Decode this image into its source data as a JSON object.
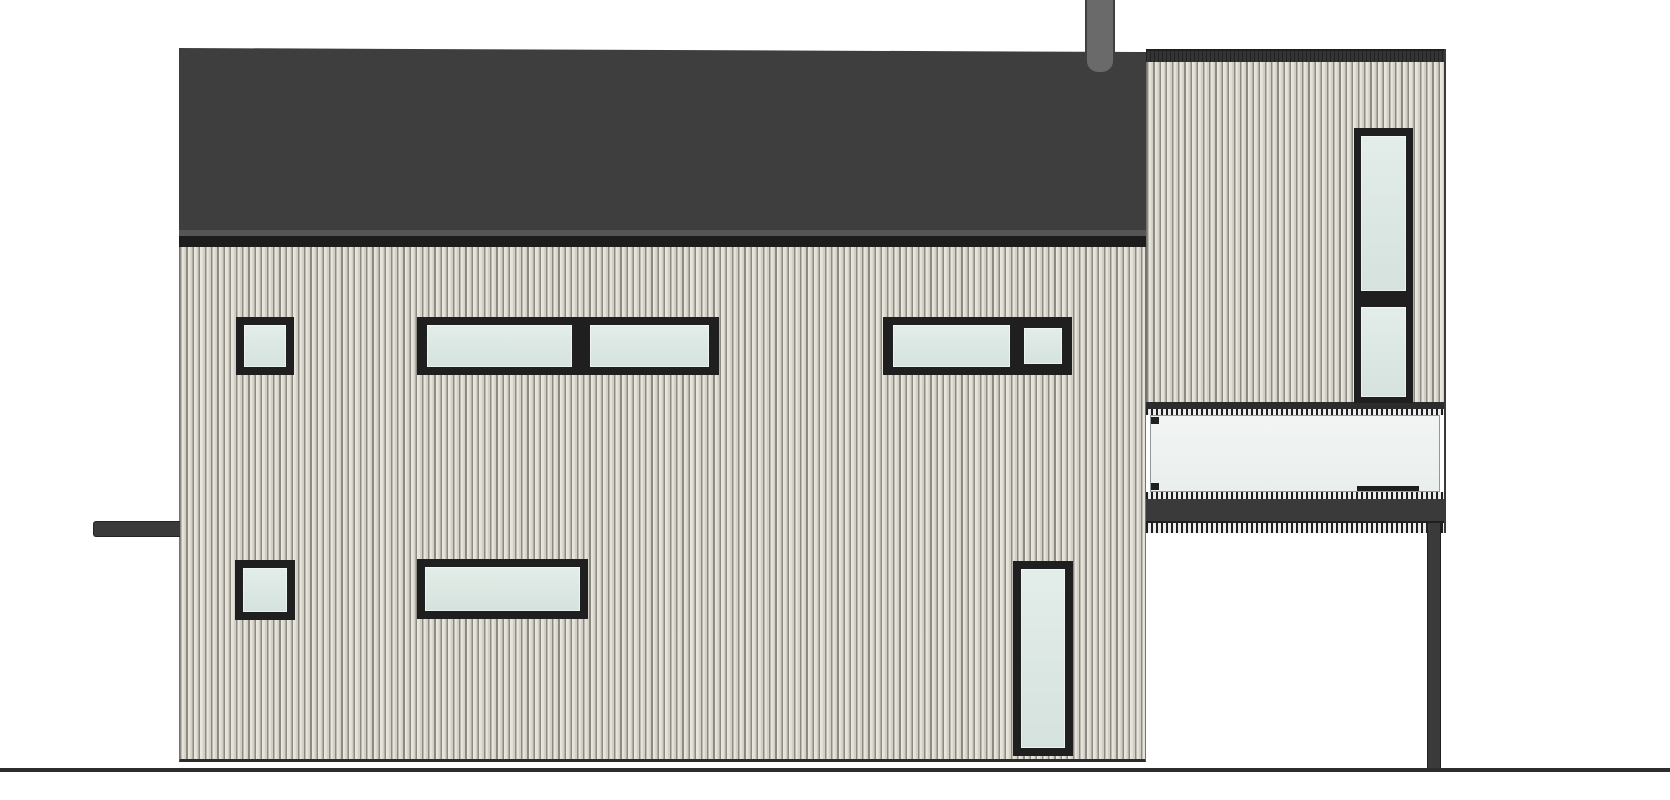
{
  "drawing": {
    "type": "architectural-elevation",
    "view": "side-elevation-of-house",
    "text_labels": [],
    "elements": [
      "low-slope dark roof",
      "chimney flue",
      "eave gutter / fascia band",
      "main facade with vertical board siding",
      "entry canopy bar on left wall",
      "upper window row",
      "lower window row",
      "cantilevered two-storey side section",
      "stacked two-pane vertical window",
      "glass balcony balustrade with top rail",
      "steel edge beam and soffit",
      "slender support post",
      "ground line"
    ],
    "windows": {
      "upper_row": [
        "small-square",
        "double-wide-pair",
        "wide-plus-small-pane"
      ],
      "lower_row": [
        "small-square",
        "wide-horizontal",
        "tall-vertical"
      ],
      "tower": [
        "stacked-two-pane-vertical"
      ]
    }
  },
  "palette": {
    "background": "#ffffff",
    "roof": "#3e3e3e",
    "eave_gap": "#565656",
    "fascia": "#1d1d1d",
    "chimney": "#6a6a6a",
    "siding_light": "#ece9e0",
    "siding_mid": "#e0ded4",
    "siding_shadow": "#d2d0c6",
    "siding_groove": "#8d8b81",
    "outline": "#75736a",
    "frame": "#1f1f1f",
    "glass": "#d5e2dd",
    "balcony_glass": "#eaefed",
    "steel": "#3a3a3a",
    "ground": "#2d2d2d"
  }
}
